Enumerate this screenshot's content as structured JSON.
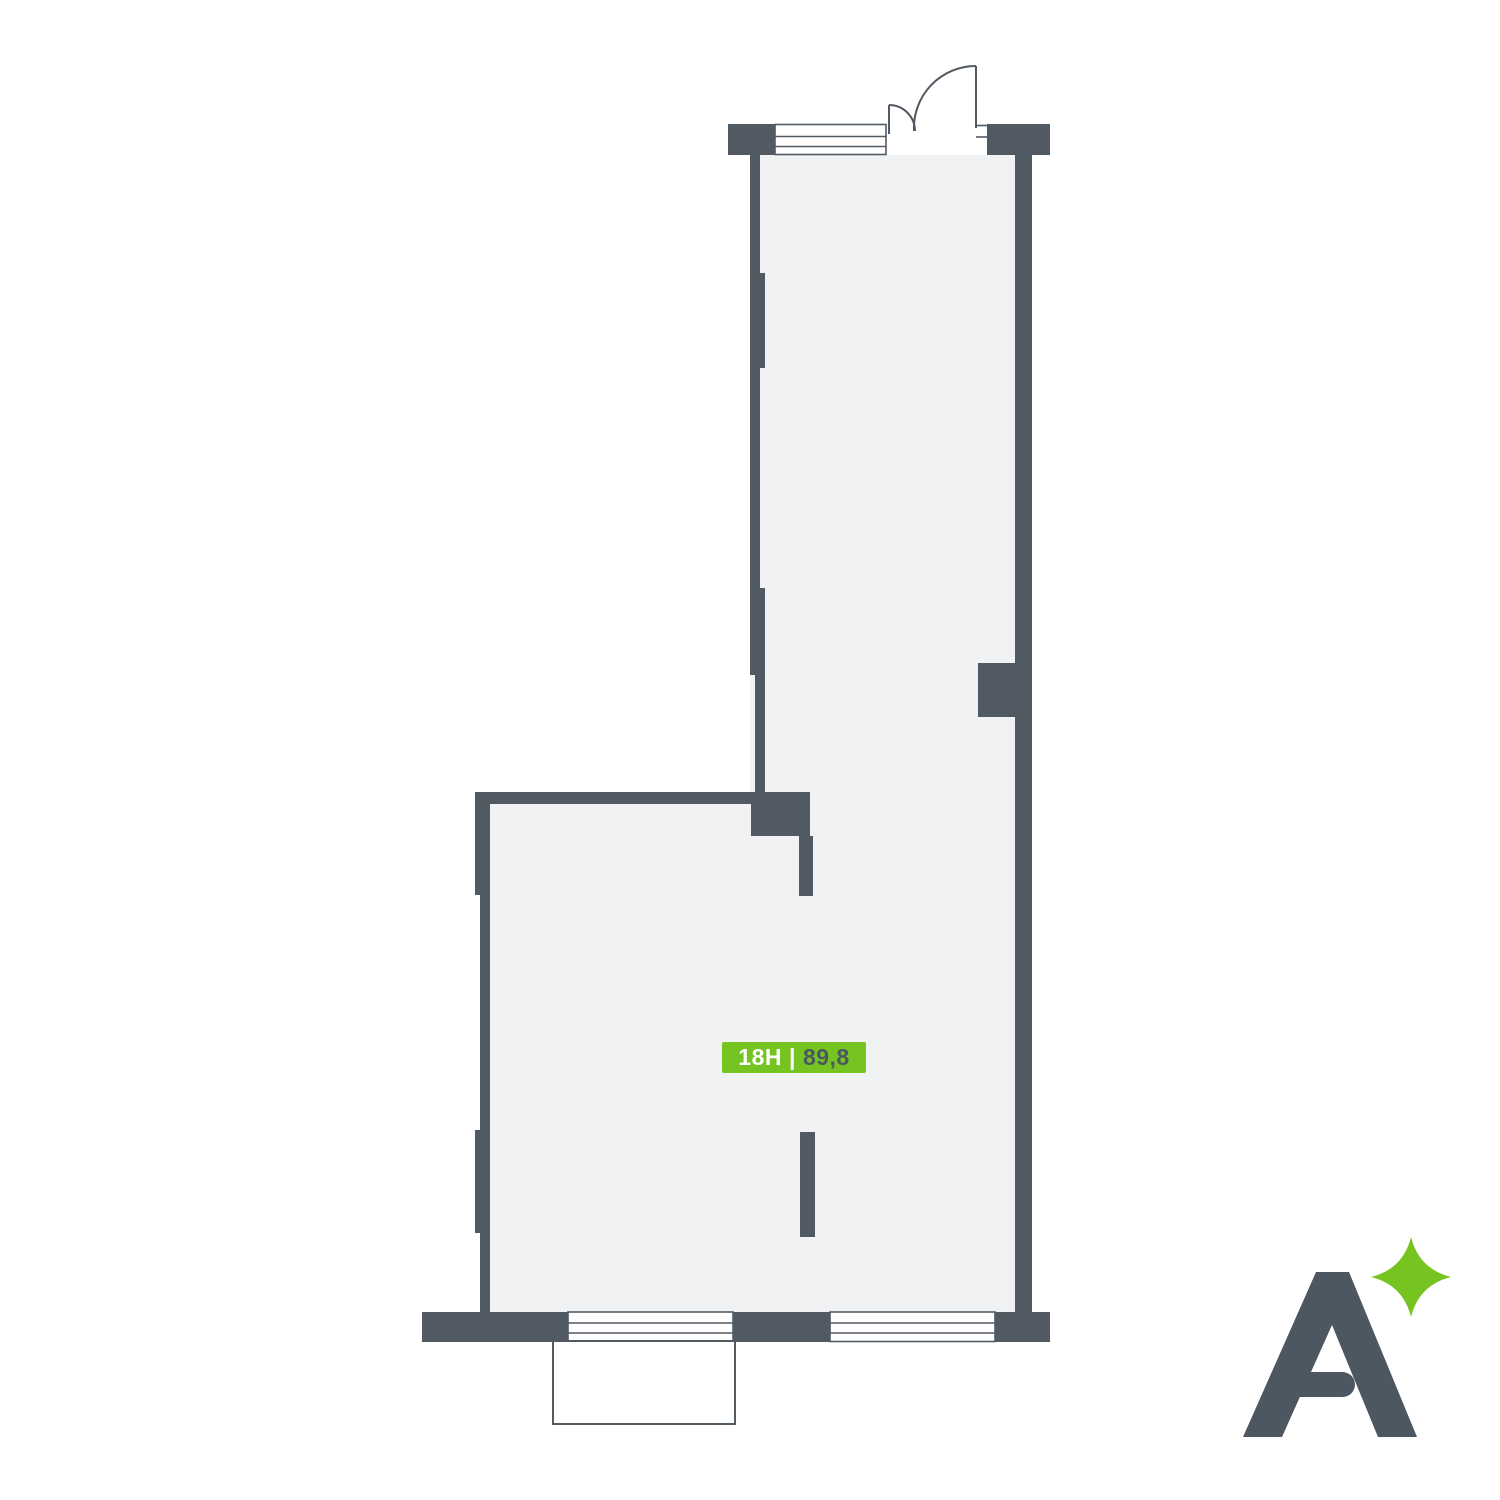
{
  "unit_badge": {
    "id": "18H",
    "separator": "|",
    "area": "89,8"
  },
  "logo": {
    "letter": "A",
    "icon": "four-point-sparkle"
  },
  "colors": {
    "wall": "#515A63",
    "floor_fill": "#F1F2F3",
    "accent_green": "#76C421",
    "logo_gray": "#4D5761",
    "badge_text_light": "#FFFFFF",
    "badge_text_dark": "#4D5761",
    "background": "#FFFFFF"
  }
}
